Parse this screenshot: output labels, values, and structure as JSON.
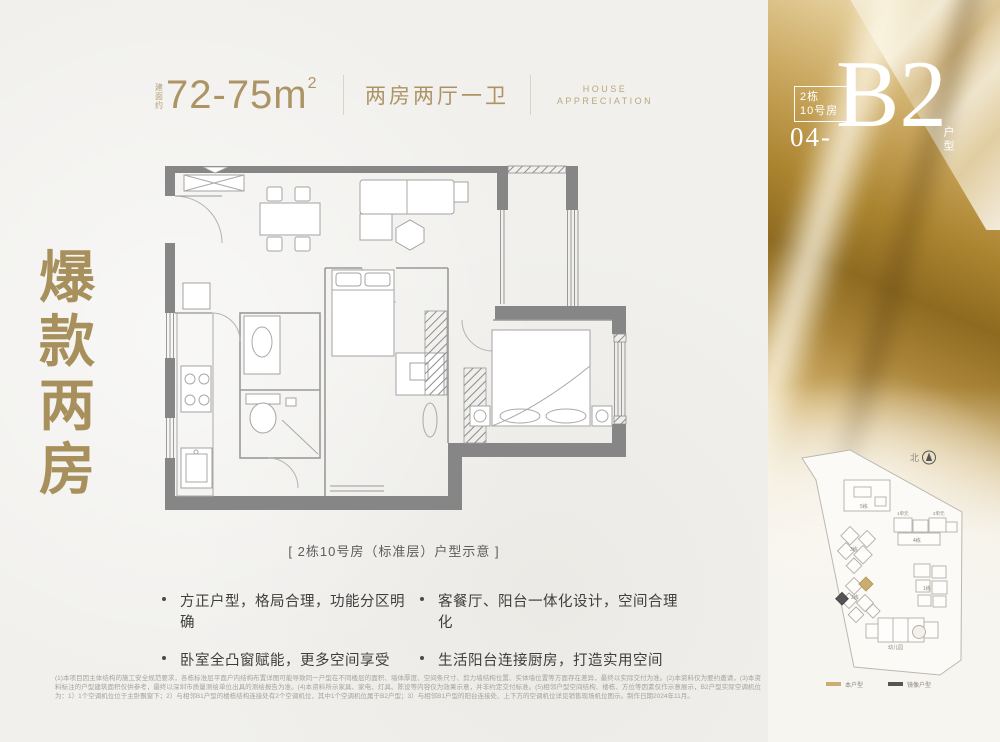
{
  "header": {
    "area_prefix_chars": [
      "建",
      "面",
      "约"
    ],
    "area_value": "72-75m",
    "area_sup": "2",
    "layout_label": "两房两厅一卫",
    "tagline_line1": "HOUSE",
    "tagline_line2": "APPRECIATION"
  },
  "unit_badge": {
    "building_line1": "2栋",
    "building_line2": "10号房",
    "unit_number": "04-",
    "unit_code": "B2",
    "unit_suffix": "户型"
  },
  "side_title": {
    "chars": [
      "爆",
      "款",
      "两",
      "房"
    ]
  },
  "floorplan": {
    "caption": "[ 2栋10号房（标准层）户型示意 ]"
  },
  "features": [
    "方正户型，格局合理，功能分区明确",
    "卧室全凸窗赋能，更多空间享受",
    "客餐厅、阳台一体化设计，空间合理化",
    "生活阳台连接厨房，打造实用空间"
  ],
  "disclaimer": "(1)本项目因主体结构的施工安全规范要求，各栋标准层平面户内结构布置详图可能导致同一户型在不同楼层的面积、墙体厚度、空间条尺寸、剪力墙结构位置、实体墙位置等方面存在差异，最终以实际交付为准。(2)本资料仅为要约邀请，(3)本资料标注的户型建筑面积仅供参考，最终以深圳市质量测绘单位出具的测绘报告为准。(4)本资料所示家具、家电、灯具、陈设等内容仅为效果示意，并非约定交付标准。(5)相邻户型空间结构、楼栋、方位等因素仅作示意展示，B2户型实际空调机位为：1）1个空调机位位于主卧飘窗下；2）与相邻B1户型的楼栋结构连接处有2个空调机位，其中1个空调机位属于B2户型；3）与相邻B1户型的阳台连接处、上下方的空调机位详见销售现场机位图示。制作日期2024年11月。",
  "siteplan": {
    "north_label": "北",
    "buildings": {
      "b5": "5栋",
      "b4": "4栋",
      "b3": "3栋",
      "b2": "2栋",
      "b1": "1栋",
      "kg": "幼儿园"
    },
    "unit_labels": {
      "u1": "1单元",
      "u2": "2单元"
    },
    "legend": {
      "this_unit": "本户型",
      "mirror_unit": "镜像户型"
    }
  },
  "colors": {
    "gold_accent": "#a8905c",
    "header_gold": "#ad9465",
    "legend_gold": "#c9ad72",
    "legend_dark": "#555555",
    "wall_gray": "#868686"
  }
}
